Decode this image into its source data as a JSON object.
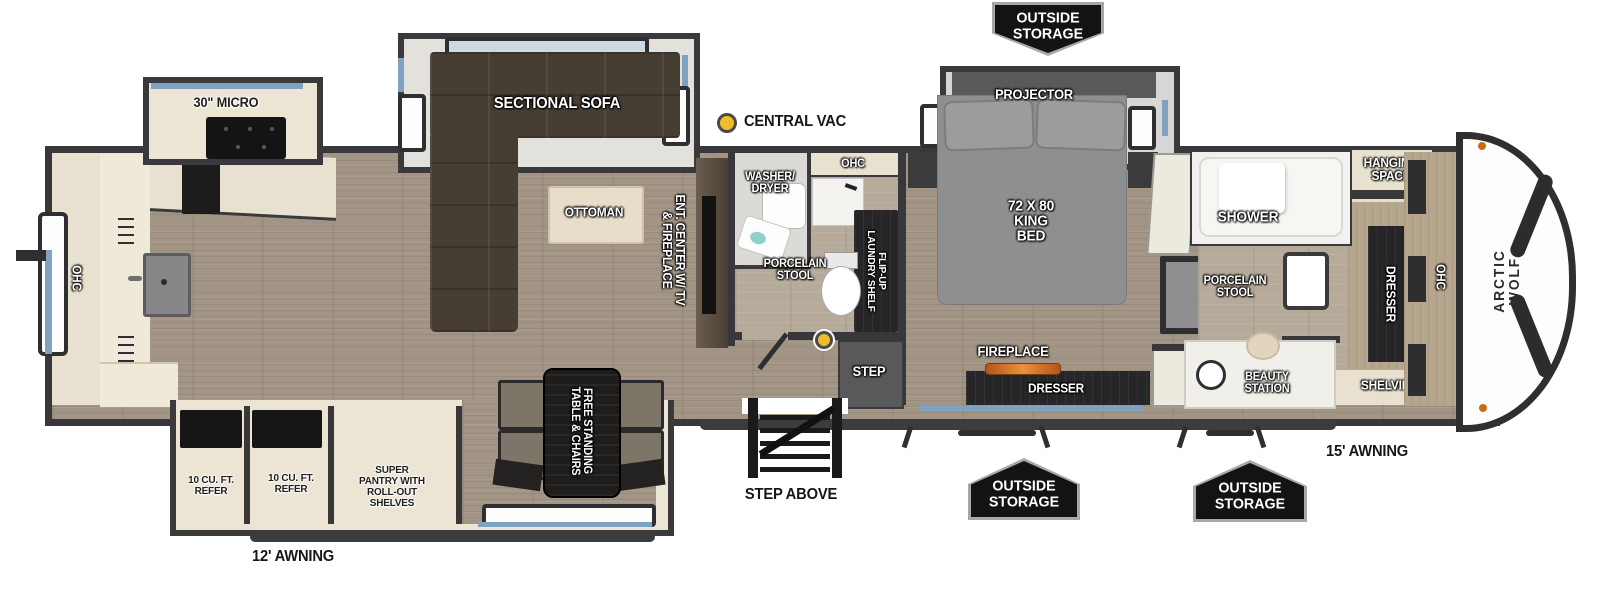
{
  "title": "Arctic Wolf fifth wheel floor plan",
  "colors": {
    "wall": "#38383a",
    "floor_wood": "#a39585",
    "floor_light": "#b6aa9b",
    "cabinet_cream": "#e8e1cf",
    "window_blue": "#7ea2c0",
    "marker_yellow": "#eebe2a",
    "flame_orange": "#d97a2a",
    "badge_black": "#131313"
  },
  "exterior": {
    "outside_storage_top": "OUTSIDE\nSTORAGE",
    "outside_storage_door": "OUTSIDE\nSTORAGE",
    "outside_storage_front": "OUTSIDE\nSTORAGE",
    "awning_main": "15' AWNING",
    "awning_rear": "12' AWNING",
    "step_above": "STEP ABOVE",
    "brand": "ARCTIC WOLF"
  },
  "annotations": {
    "central_vac": "CENTRAL VAC"
  },
  "kitchen": {
    "micro": "30\" MICRO",
    "ohc_rear": "OHC",
    "refer_1": "10 CU. FT.\nREFER",
    "refer_2": "10 CU. FT.\nREFER",
    "pantry": "SUPER\nPANTRY WITH\nROLL-OUT\nSHELVES"
  },
  "living": {
    "sofa": "SECTIONAL SOFA",
    "ottoman": "OTTOMAN",
    "ent_center": "ENT. CENTER W/ TV\n& FIREPLACE",
    "dinette": "FREE STANDING\nTABLE & CHAIRS"
  },
  "bath_mid": {
    "washer_dryer": "WASHER/\nDRYER",
    "ohc": "OHC",
    "laundry_shelf": "FLIP-UP\nLAUNDRY SHELF",
    "toilet": "PORCELAIN\nSTOOL",
    "step": "STEP"
  },
  "bedroom": {
    "projector": "PROJECTOR",
    "bed": "72 X 80\nKING\nBED",
    "fireplace": "FIREPLACE",
    "dresser": "DRESSER"
  },
  "bath_front": {
    "shower": "SHOWER",
    "hanging_space": "HANGING\nSPACE",
    "toilet": "PORCELAIN\nSTOOL",
    "dresser": "DRESSER",
    "beauty_station": "BEAUTY\nSTATION",
    "shelving": "SHELVING",
    "ohc": "OHC"
  }
}
